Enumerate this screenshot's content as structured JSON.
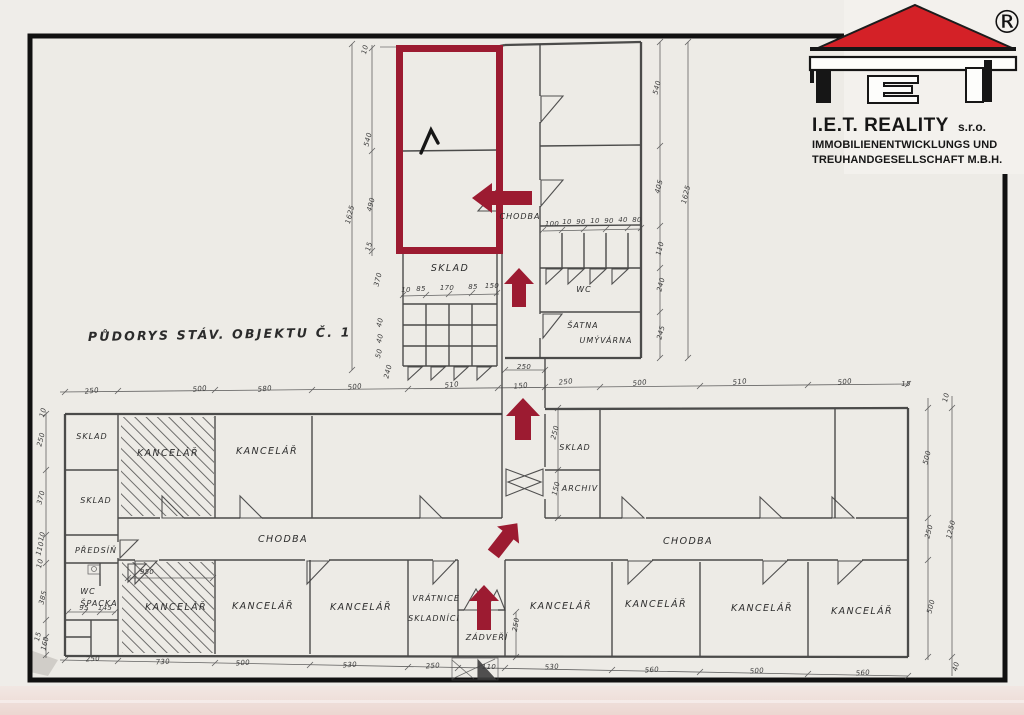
{
  "colors": {
    "highlight": "#9c1b31",
    "logo_red": "#d42127",
    "ink": "#3a3a3a",
    "frame": "#111111",
    "paper": "#edebe6"
  },
  "logo": {
    "registered": "®",
    "brand": "I.E.T. REALITY",
    "suffix": "s.r.o.",
    "line2": "IMMOBILIENENTWICKLUNGS UND",
    "line3": "TREUHANDGESELLSCHAFT M.B.H."
  },
  "title": "PŮDORYS STÁV. OBJEKTU Č. 1",
  "room_labels": [
    "CHODBA",
    "SKLAD",
    "WC",
    "ŠATNA",
    "UMÝVÁRNA",
    "SKLAD",
    "KANCELÁŘ",
    "KANCELÁŘ",
    "SKLAD",
    "PŘEDSÍŇ",
    "SKLAD",
    "ARCHIV",
    "CHODBA",
    "CHODBA",
    "WC",
    "ŠPACKA",
    "KANCELÁŘ",
    "KANCELÁŘ",
    "KANCELÁŘ",
    "VRÁTNICE",
    "SKLADNÍCI",
    "ZÁDVEŘÍ",
    "KANCELÁŘ",
    "KANCELÁŘ",
    "KANCELÁŘ",
    "KANCELÁŘ"
  ],
  "dims": [
    "250",
    "500",
    "580",
    "500",
    "510",
    "150",
    "250",
    "500",
    "510",
    "500",
    "15",
    "250",
    "730",
    "500",
    "530",
    "250",
    "110",
    "530",
    "560",
    "500",
    "560",
    "10",
    "540",
    "490",
    "15",
    "1625",
    "540",
    "405",
    "110",
    "240",
    "245",
    "1625",
    "10",
    "250",
    "370",
    "10",
    "110",
    "10",
    "385",
    "15",
    "160",
    "10",
    "500",
    "250",
    "500",
    "1250",
    "40",
    "250",
    "250",
    "150",
    "100",
    "10",
    "90",
    "10",
    "90",
    "40",
    "80",
    "10",
    "85",
    "170",
    "85",
    "150",
    "370",
    "40",
    "40",
    "50",
    "240",
    "950",
    "95",
    "145",
    "250"
  ],
  "annotations": {
    "highlight_shape": "rectangle-outline",
    "arrow_directions": [
      "left",
      "up",
      "up",
      "up-right",
      "up"
    ]
  }
}
